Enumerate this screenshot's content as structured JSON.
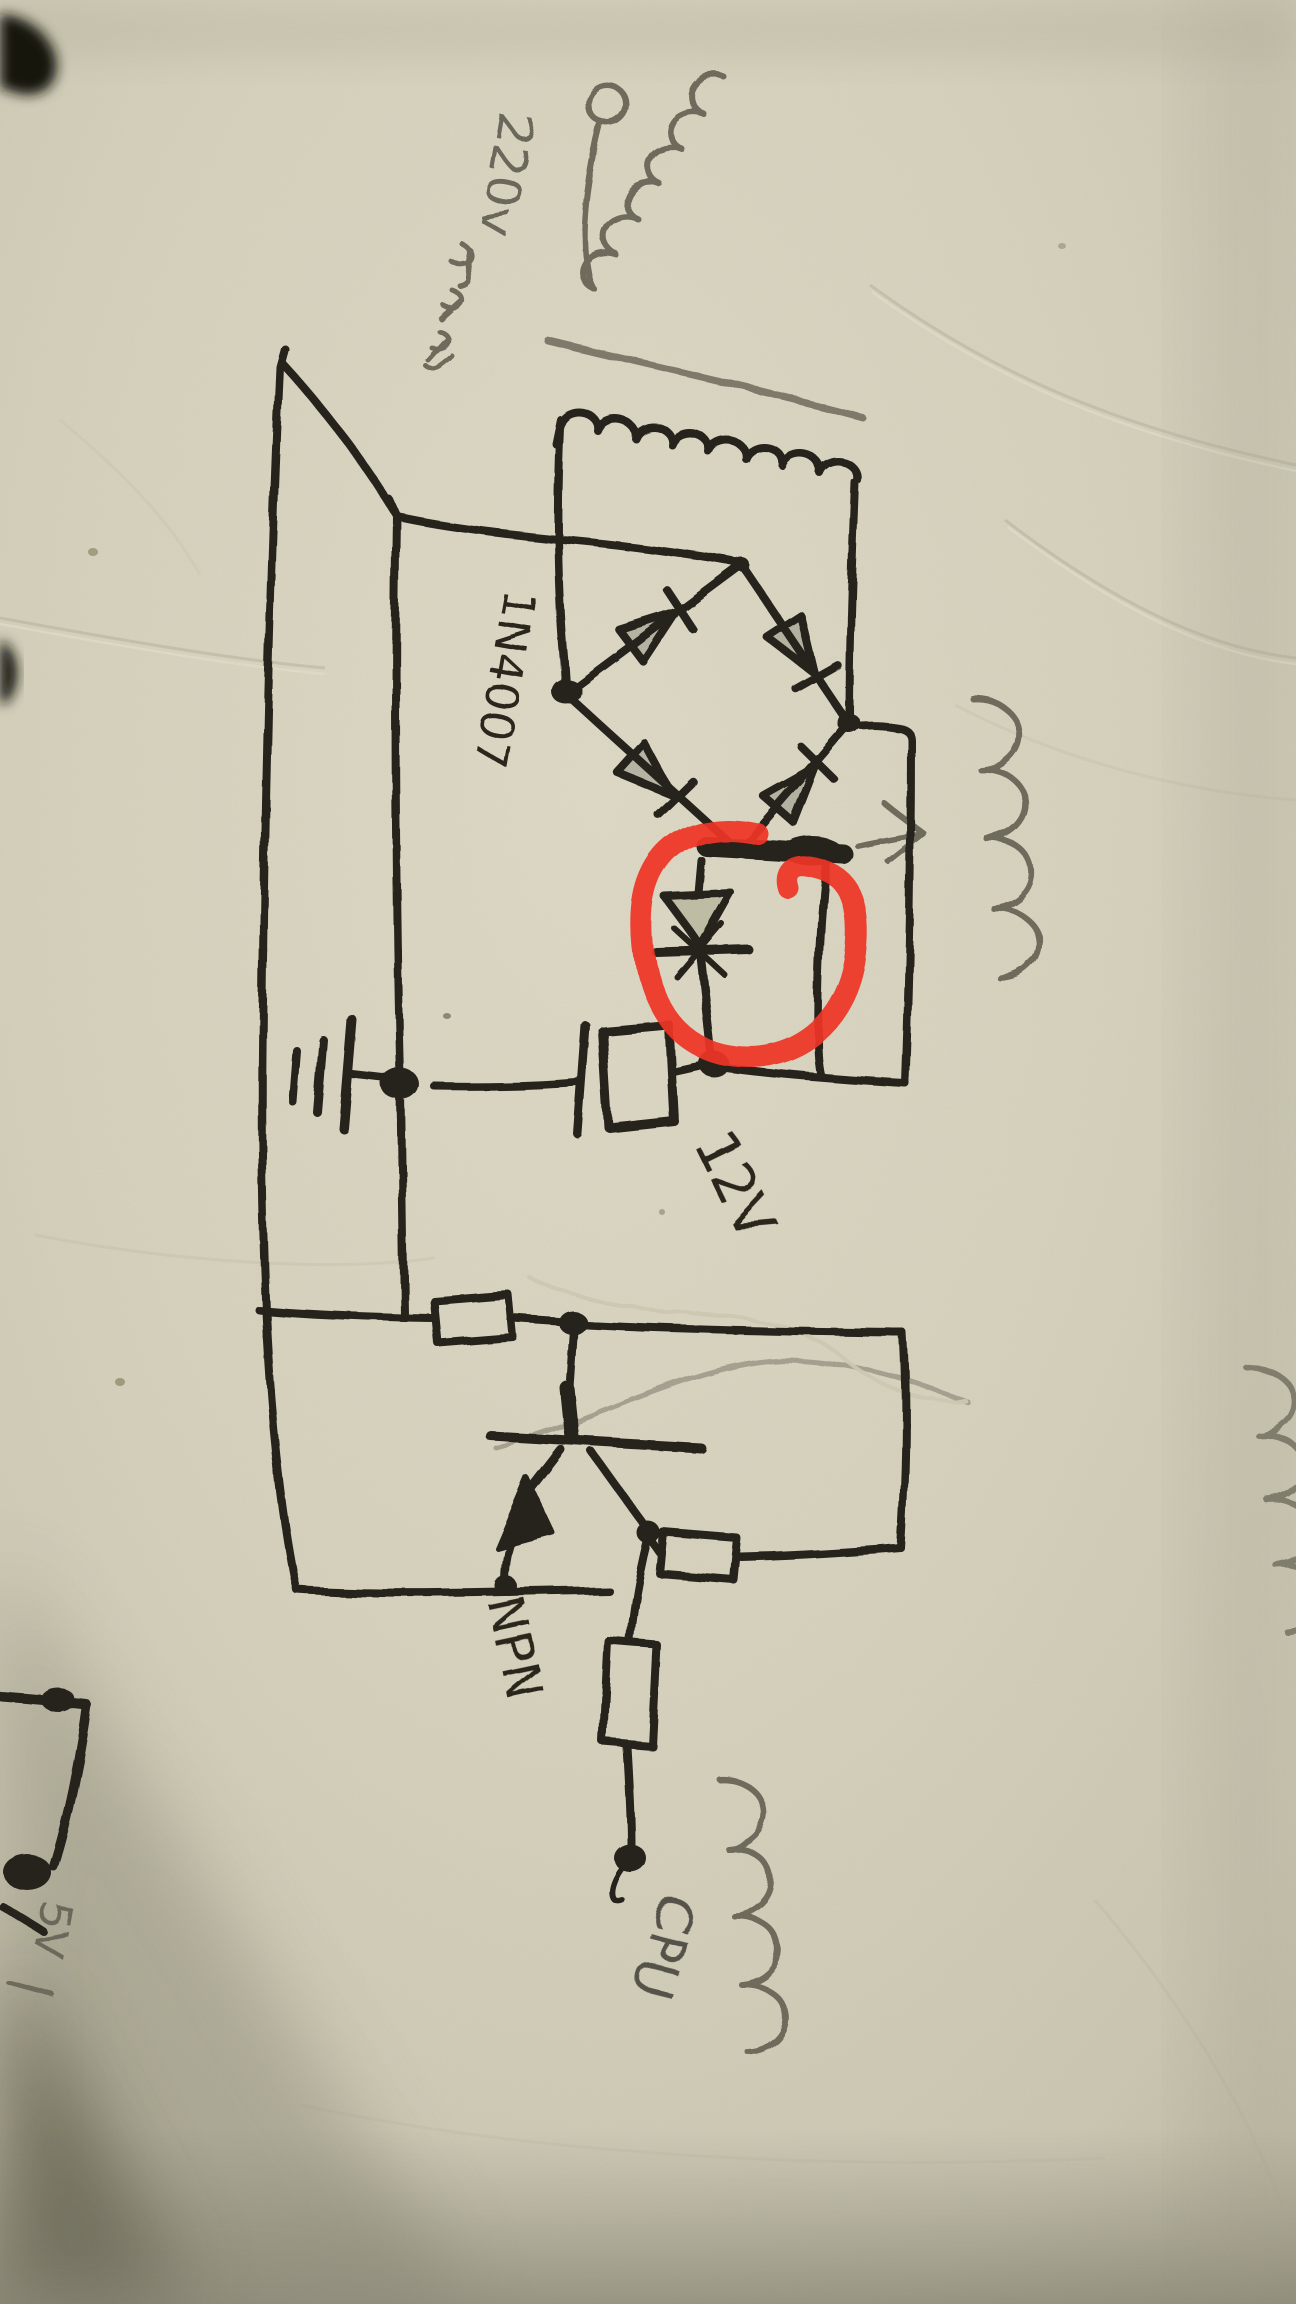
{
  "photo": {
    "labels": {
      "mains_voltage": "220v",
      "transformer_cn": "变压器",
      "diode_part_number": "1N4007",
      "output_voltage": "12V",
      "transistor_type": "NPN",
      "cpu_terminal": "CPU",
      "edge_voltage": "5V"
    },
    "colors": {
      "paper": "#d6d2bd",
      "ink": "#26241d",
      "pencil": "#6e6a5c",
      "highlight_red": "#ee3426"
    },
    "annotation": {
      "highlight_shape": "red-circle",
      "highlighted_component": "diode"
    }
  }
}
